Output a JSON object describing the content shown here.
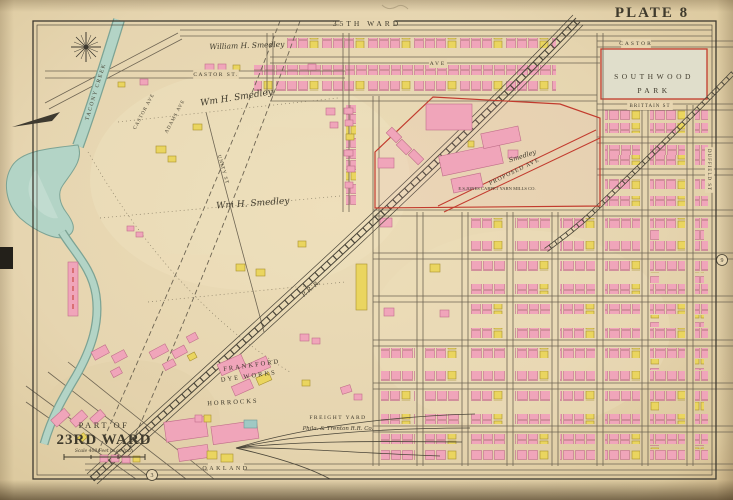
{
  "page": {
    "plate": "PLATE 8",
    "ward_top": "35TH WARD",
    "corner": {
      "part_of": "PART OF",
      "ward": "23RD WARD",
      "scale": "Scale 400 Feet to an Inch"
    }
  },
  "palette": {
    "paper": "#e6d5b0",
    "brick_pink": "#f0a5ba",
    "frame_yellow": "#ead55f",
    "water_blue": "#b3d4c6",
    "park_green": "#e0decb",
    "red_line": "#c23b2e",
    "ink": "#3f3a2c"
  },
  "map": {
    "labels": [
      {
        "name": "plate-number",
        "text": "PLATE 8",
        "x": 652,
        "y": 17,
        "size": 15,
        "cls": "bold",
        "ls": 2,
        "color": "#383428"
      },
      {
        "name": "ward-top-label",
        "text": "35TH WARD",
        "x": 367,
        "y": 26,
        "size": 7.5,
        "ls": 3,
        "gap": true
      },
      {
        "name": "street-castor-right",
        "text": "CASTOR",
        "x": 636,
        "y": 45,
        "size": 5.5,
        "ls": 2,
        "gap": true
      },
      {
        "name": "park-name-line1",
        "text": "SOUTHWOOD",
        "x": 654,
        "y": 79,
        "size": 7.5,
        "ls": 3.5,
        "color": "#65654f"
      },
      {
        "name": "park-name-line2",
        "text": "PARK",
        "x": 654,
        "y": 93,
        "size": 7.5,
        "ls": 3.5,
        "color": "#65654f"
      },
      {
        "name": "street-brittain",
        "text": "BRITTAIN ST",
        "x": 650,
        "y": 107,
        "size": 5,
        "ls": 1,
        "gap": true
      },
      {
        "name": "street-duffield",
        "text": "DUFFIELD ST",
        "x": 708,
        "y": 170,
        "size": 5,
        "rot": 90,
        "ls": 1,
        "gap": true
      },
      {
        "name": "street-castor-left",
        "text": "CASTOR ST.",
        "x": 216,
        "y": 76,
        "size": 5.5,
        "ls": 1.5,
        "gap": true
      },
      {
        "name": "street-ave",
        "text": "AVE",
        "x": 438,
        "y": 65,
        "size": 5.5,
        "ls": 2,
        "gap": true
      },
      {
        "name": "owner-william-smedley",
        "text": "William H. Smedley",
        "x": 247,
        "y": 48,
        "size": 7.5,
        "cls": "cursive",
        "rot": -2
      },
      {
        "name": "owner-wm-smedley-1",
        "text": "Wm H. Smedley",
        "x": 237,
        "y": 100,
        "size": 9,
        "cls": "cursive",
        "rot": -9
      },
      {
        "name": "owner-wm-smedley-2",
        "text": "Wm H. Smedley",
        "x": 253,
        "y": 206,
        "size": 9,
        "cls": "cursive",
        "rot": -4
      },
      {
        "name": "street-castor-ave",
        "text": "CASTOR AVE",
        "x": 145,
        "y": 112,
        "size": 5,
        "rot": -62,
        "ls": 1
      },
      {
        "name": "street-adams-ave",
        "text": "ADAMS AVE",
        "x": 176,
        "y": 117,
        "size": 5,
        "rot": -62,
        "ls": 1
      },
      {
        "name": "street-unity",
        "text": "UNITY ST",
        "x": 222,
        "y": 170,
        "size": 5,
        "rot": 74,
        "ls": 1
      },
      {
        "name": "creek-name",
        "text": "TACONY CREEK",
        "x": 97,
        "y": 92,
        "size": 5.5,
        "rot": -73,
        "ls": 1.5,
        "color": "#4a5a4c"
      },
      {
        "name": "railroad-name",
        "text": "P. R. R.",
        "x": 312,
        "y": 290,
        "size": 6,
        "rot": -41,
        "cls": "cursive"
      },
      {
        "name": "property-proposed-ave",
        "text": "PROPOSED AVE",
        "x": 515,
        "y": 173,
        "size": 6,
        "rot": -26,
        "ls": 1,
        "color": "#c23b2e"
      },
      {
        "name": "owner-smedley-est",
        "text": "Smedley",
        "x": 523,
        "y": 158,
        "size": 6.5,
        "cls": "cursive",
        "rot": -18
      },
      {
        "name": "label-carpet-mills",
        "text": "E.S.JONES CARPET YARN MILLS CO.",
        "x": 497,
        "y": 190,
        "size": 4.6
      },
      {
        "name": "label-frankford",
        "text": "FRANKFORD",
        "x": 252,
        "y": 367,
        "size": 6.5,
        "ls": 2,
        "rot": -8
      },
      {
        "name": "label-dye-works",
        "text": "DYE WORKS",
        "x": 249,
        "y": 378,
        "size": 6.5,
        "ls": 2,
        "rot": -8
      },
      {
        "name": "label-horrocks",
        "text": "HORROCKS",
        "x": 233,
        "y": 404,
        "size": 6.5,
        "ls": 2,
        "rot": -3
      },
      {
        "name": "label-freight-yard",
        "text": "FREIGHT YARD",
        "x": 338,
        "y": 419,
        "size": 5.5,
        "ls": 1.5
      },
      {
        "name": "label-freight-yard-co",
        "text": "Phila. & Trenton R.R. Co.",
        "x": 338,
        "y": 430,
        "size": 5.5,
        "cls": "cursive"
      },
      {
        "name": "street-oakland",
        "text": "OAKLAND",
        "x": 226,
        "y": 470,
        "size": 6,
        "ls": 2.5,
        "gap": true
      },
      {
        "name": "corner-part-of",
        "text": "PART OF",
        "x": 104,
        "y": 428,
        "size": 8.5,
        "ls": 2.5
      },
      {
        "name": "corner-ward",
        "text": "23RD WARD",
        "x": 104,
        "y": 444,
        "size": 15,
        "cls": "bold",
        "ls": 1
      },
      {
        "name": "corner-scale",
        "text": "Scale 400 Feet to an Inch",
        "x": 104,
        "y": 452,
        "size": 4.5,
        "cls": "cursive"
      },
      {
        "name": "plate-ref-bottom",
        "text": "3",
        "x": 152,
        "y": 477,
        "size": 6,
        "circle": true
      },
      {
        "name": "plate-ref-right",
        "text": "9",
        "x": 722,
        "y": 262,
        "size": 6,
        "circle": true
      }
    ]
  }
}
